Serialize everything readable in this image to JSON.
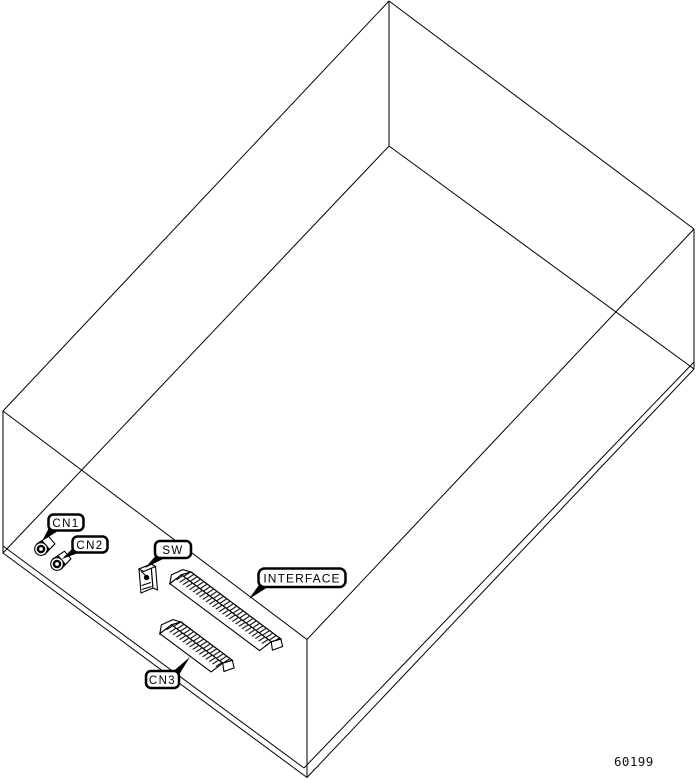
{
  "figure": {
    "number": "60199"
  },
  "colors": {
    "line": "#000000",
    "background": "#ffffff"
  },
  "callouts": {
    "cn1": {
      "text": "CN1"
    },
    "cn2": {
      "text": "CN2"
    },
    "sw": {
      "text": "SW"
    },
    "interface": {
      "text": "INTERFACE"
    },
    "cn3": {
      "text": "CN3"
    }
  }
}
